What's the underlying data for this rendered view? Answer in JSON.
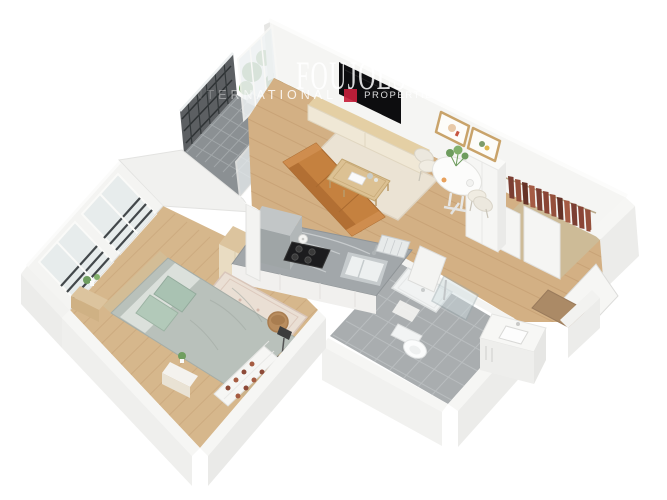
{
  "watermark": {
    "title": "FOUJOLS",
    "subtitle_left": "INTERNATIONAL",
    "subtitle_right": "PROPERTIES",
    "square_style": "background:#c5203c"
  },
  "scene": {
    "type": "3d-floorplan-render",
    "rooms": [
      "living-room",
      "dining-area",
      "kitchen",
      "bedroom",
      "bathroom",
      "balcony",
      "entry-hall",
      "closet"
    ],
    "palette": {
      "wall": "#f4f4f2",
      "wall_shade": "#ececea",
      "wood_floor": "#d3b084",
      "wood_line": "#c19a6e",
      "balcony_tile": "#8b9093",
      "bath_tile": "#a9adaf",
      "sofa": "#c5813f",
      "bed_duvet": "#b9c1bb",
      "pillow": "#a9c2b2",
      "rug": "#ebe3d4",
      "plant": "#6f9e5f",
      "railing": "#45494c",
      "clothes": "#8a4536",
      "accent_red": "#c5203c"
    }
  }
}
